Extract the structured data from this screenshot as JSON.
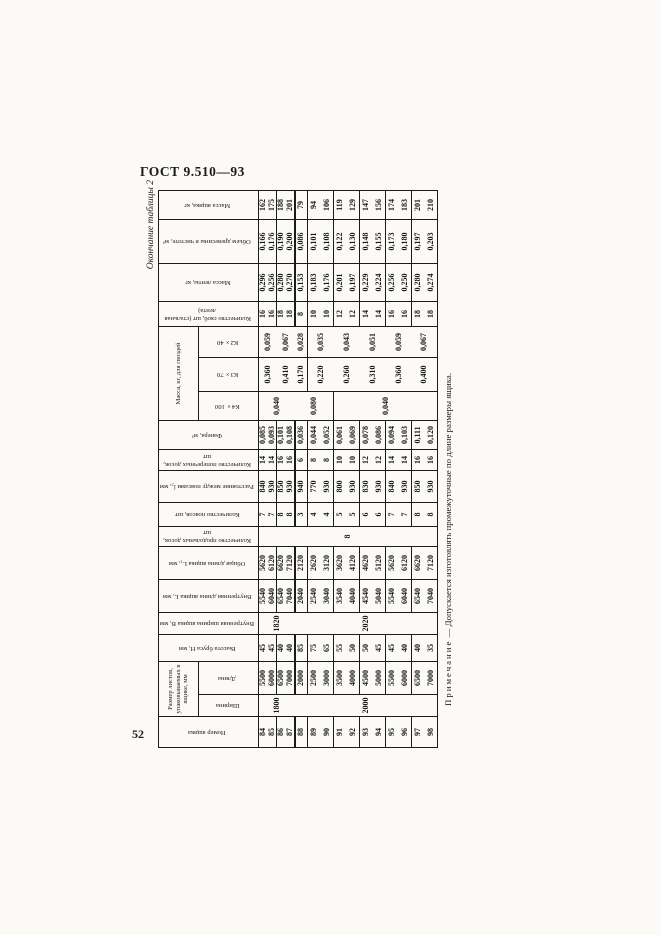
{
  "page": {
    "standard_code": "ГОСТ 9.510—93",
    "page_number": "52"
  },
  "table": {
    "caption": "Окончание таблицы 2",
    "note": {
      "label": "Примечание",
      "text": " — Допускается изготовлять промежуточные по длине размеры ящика."
    },
    "header_row1": [
      {
        "t": "Номер ящика",
        "rs": 2,
        "v": true
      },
      {
        "t": "Размер листов, упаковываемых в ящике, мм",
        "cs": 2
      },
      {
        "t": "Высота бруса Н, мм",
        "rs": 2,
        "v": true
      },
      {
        "t": "Внутренняя ширина ящика В, мм",
        "rs": 2,
        "v": true
      },
      {
        "t": "Внутренняя длина ящика L, мм",
        "rs": 2,
        "v": true
      },
      {
        "t": "Общая длина ящика L₁, мм",
        "rs": 2,
        "v": true
      },
      {
        "t": "Количество продольных досок, шт",
        "rs": 2,
        "v": true
      },
      {
        "t": "Количество поясов, шт",
        "rs": 2,
        "v": true
      },
      {
        "t": "Расстояние между поясами l₂, мм",
        "rs": 2,
        "v": true
      },
      {
        "t": "Количество поперечных досок, шт",
        "rs": 2,
        "v": true
      },
      {
        "t": "Фанера, м³",
        "rs": 2,
        "v": true
      },
      {
        "t": "Масса, кг, для гвоздей",
        "cs": 3
      },
      {
        "t": "Количество скоб, шт (стальная лента)",
        "rs": 2,
        "v": true
      },
      {
        "t": "Масса ленты, кг",
        "rs": 2,
        "v": true
      },
      {
        "t": "Объем древесины в чистоте, м³",
        "rs": 2,
        "v": true
      },
      {
        "t": "Масса ящика, кг",
        "rs": 2,
        "v": true
      }
    ],
    "header_row2": [
      {
        "t": "Ширина",
        "v": true
      },
      {
        "t": "Длина",
        "v": true
      },
      {
        "t": "К4×100",
        "v": true
      },
      {
        "t": "К3×70",
        "v": true
      },
      {
        "t": "К2×40",
        "v": true
      }
    ],
    "rows": [
      {
        "h": "s",
        "cells": [
          "84",
          [
            "1800",
            4
          ],
          "5500",
          "45",
          [
            "1820",
            4
          ],
          "5540",
          "5620",
          [
            "8",
            15
          ],
          "7",
          "840",
          "14",
          "0,085",
          [
            "0,040",
            4
          ],
          [
            "0,360",
            2
          ],
          [
            "0,059",
            2
          ],
          "16",
          "0,296",
          "0,166",
          "162"
        ]
      },
      {
        "h": "s",
        "sep": "thin",
        "cells": [
          "85",
          "6000",
          "45",
          "6040",
          "6120",
          "7",
          "930",
          "14",
          "0,093",
          "16",
          "0,256",
          "0,176",
          "175"
        ]
      },
      {
        "h": "s",
        "cells": [
          "86",
          "6500",
          "40",
          "6540",
          "6620",
          "8",
          "850",
          "16",
          "0,101",
          [
            "0,410",
            2
          ],
          [
            "0,067",
            2
          ],
          "18",
          "0,280",
          "0,190",
          "188"
        ]
      },
      {
        "h": "s",
        "sep": "thick",
        "cells": [
          "87",
          "7000",
          "40",
          "7040",
          "7120",
          "8",
          "930",
          "16",
          "0,108",
          "18",
          "0,270",
          "0,200",
          "201"
        ]
      },
      {
        "sep": "thin",
        "cells": [
          "88",
          [
            "2000",
            11
          ],
          "2000",
          "85",
          [
            "2020",
            11
          ],
          "2040",
          "2120",
          "3",
          "940",
          "6",
          "0,036",
          [
            "0,080",
            3
          ],
          "0,170",
          "0,028",
          "8",
          "0,153",
          "0,086",
          "79"
        ]
      },
      {
        "cells": [
          "89",
          "2500",
          "75",
          "2540",
          "2620",
          "4",
          "770",
          "8",
          "0,044",
          [
            "0,220",
            2
          ],
          [
            "0,035",
            2
          ],
          "10",
          "0,183",
          "0,101",
          "94"
        ]
      },
      {
        "sep": "thin",
        "cells": [
          "90",
          "3000",
          "65",
          "3040",
          "3120",
          "4",
          "930",
          "8",
          "0,052",
          "10",
          "0,176",
          "0,108",
          "106"
        ]
      },
      {
        "cells": [
          "91",
          "3500",
          "55",
          "3540",
          "3620",
          "5",
          "800",
          "10",
          "0,061",
          [
            "0,040",
            8
          ],
          [
            "0,260",
            2
          ],
          [
            "0,043",
            2
          ],
          "12",
          "0,201",
          "0,122",
          "119"
        ]
      },
      {
        "sep": "thin",
        "cells": [
          "92",
          "4000",
          "50",
          "4040",
          "4120",
          "5",
          "930",
          "10",
          "0,069",
          "12",
          "0,197",
          "0,130",
          "129"
        ]
      },
      {
        "cells": [
          "93",
          "4500",
          "50",
          "4540",
          "4620",
          "6",
          "830",
          "12",
          "0,078",
          [
            "0,310",
            2
          ],
          [
            "0,051",
            2
          ],
          "14",
          "0,229",
          "0,148",
          "147"
        ]
      },
      {
        "sep": "thin",
        "cells": [
          "94",
          "5000",
          "45",
          "5040",
          "5120",
          "6",
          "930",
          "12",
          "0,086",
          "14",
          "0,224",
          "0,155",
          "156"
        ]
      },
      {
        "cells": [
          "95",
          "5500",
          "45",
          "5540",
          "5620",
          "7",
          "840",
          "14",
          "0,094",
          [
            "0,360",
            2
          ],
          [
            "0,059",
            2
          ],
          "16",
          "0,256",
          "0,173",
          "174"
        ]
      },
      {
        "sep": "thin",
        "cells": [
          "96",
          "6000",
          "40",
          "6040",
          "6120",
          "7",
          "930",
          "14",
          "0,103",
          "16",
          "0,250",
          "0,180",
          "183"
        ]
      },
      {
        "cells": [
          "97",
          "6500",
          "40",
          "6540",
          "6620",
          "8",
          "850",
          "16",
          "0,111",
          [
            "0,400",
            2
          ],
          [
            "0,067",
            2
          ],
          "18",
          "0,280",
          "0,197",
          "201"
        ]
      },
      {
        "cells": [
          "98",
          "7000",
          "35",
          "7040",
          "7120",
          "8",
          "930",
          "16",
          "0,120",
          "18",
          "0,274",
          "0,203",
          "210"
        ]
      }
    ]
  }
}
